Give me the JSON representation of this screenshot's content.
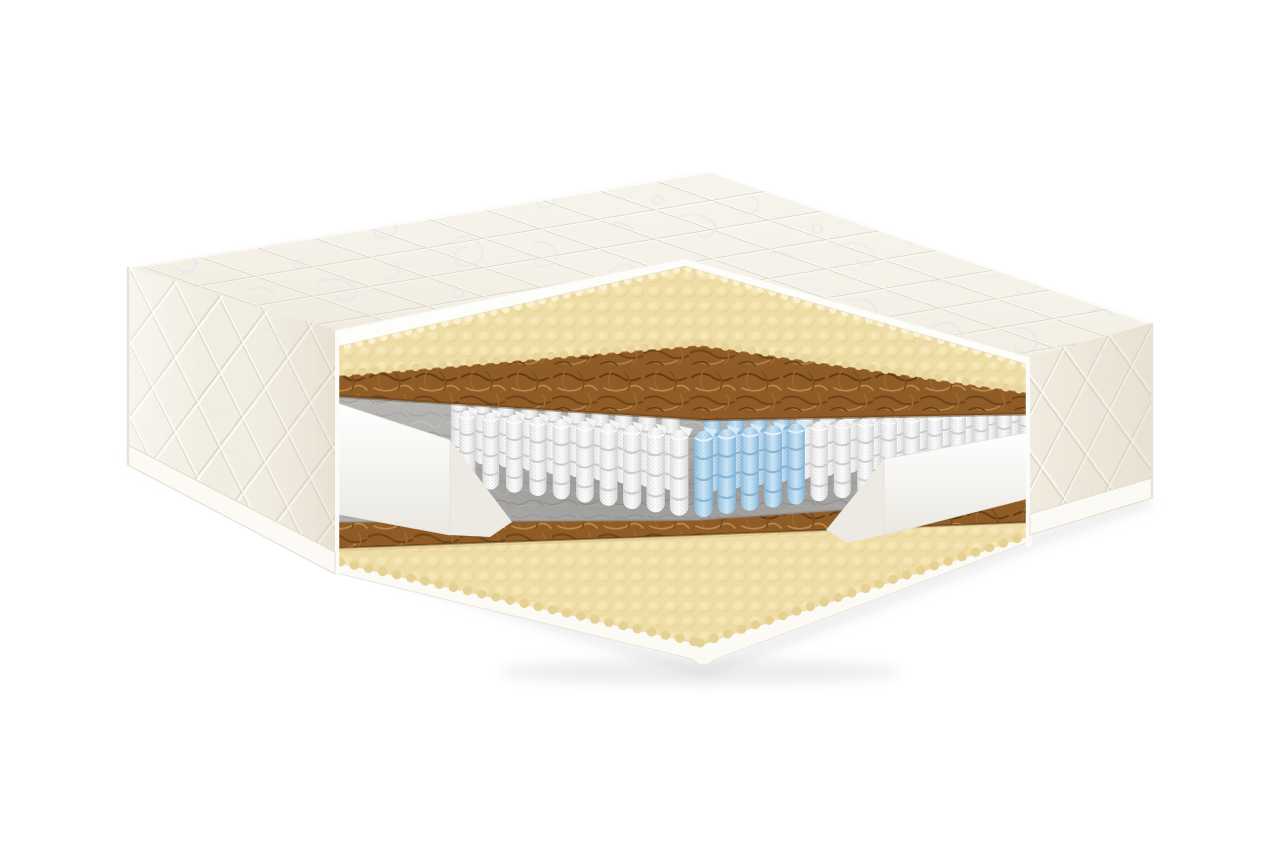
{
  "illustration": {
    "alt": "Cutaway 3D render of a two-sided spring mattress showing its internal layers",
    "background_color": "#ffffff",
    "parts": [
      {
        "name": "quilted-top-cover"
      },
      {
        "name": "egg-crate-foam-layer"
      },
      {
        "name": "coconut-coir-layer"
      },
      {
        "name": "felt-layer"
      },
      {
        "name": "pocket-spring-block"
      },
      {
        "name": "comfort-zone-springs"
      },
      {
        "name": "foam-encasement-rail"
      },
      {
        "name": "felt-layer-lower"
      },
      {
        "name": "coconut-coir-layer-lower"
      },
      {
        "name": "egg-crate-foam-layer-lower"
      },
      {
        "name": "quilted-side-border"
      },
      {
        "name": "base-cover"
      }
    ],
    "springs": {
      "left_wall": {
        "count": 10,
        "blue_count": 0
      },
      "right_wall": {
        "count": 15,
        "blue_count": 5
      },
      "rows": 2
    }
  },
  "colors": {
    "background": "#ffffff",
    "cover_base": "#f6f3ea",
    "cover_shadow": "#e4dcc8",
    "cover_edge": "#fdfdf9",
    "quilt_line": "#d8d1bf",
    "ornament": "#dee7f5",
    "panel_base": "#f2ede1",
    "foam_base": "#f1dfa9",
    "foam_hi": "#fbf2cf",
    "foam_shadow": "#d9bc7d",
    "coir_base": "#8f5c28",
    "coir_dark": "#5e3a12",
    "coir_light": "#c08d4a",
    "felt_base": "#b6b4b1",
    "felt_dark": "#9d9b98",
    "felt_light": "#cac8c5",
    "spring_white": "#f2f2f2",
    "spring_shade": "#c7c7c7",
    "spring_blue": "#b8dbf2",
    "spring_blue_shade": "#7eafd3",
    "rail_white": "#fcfcfa",
    "rail_shade": "#eceae3",
    "base_white": "#fbfaf5",
    "shadow": "#9a9a9a"
  }
}
